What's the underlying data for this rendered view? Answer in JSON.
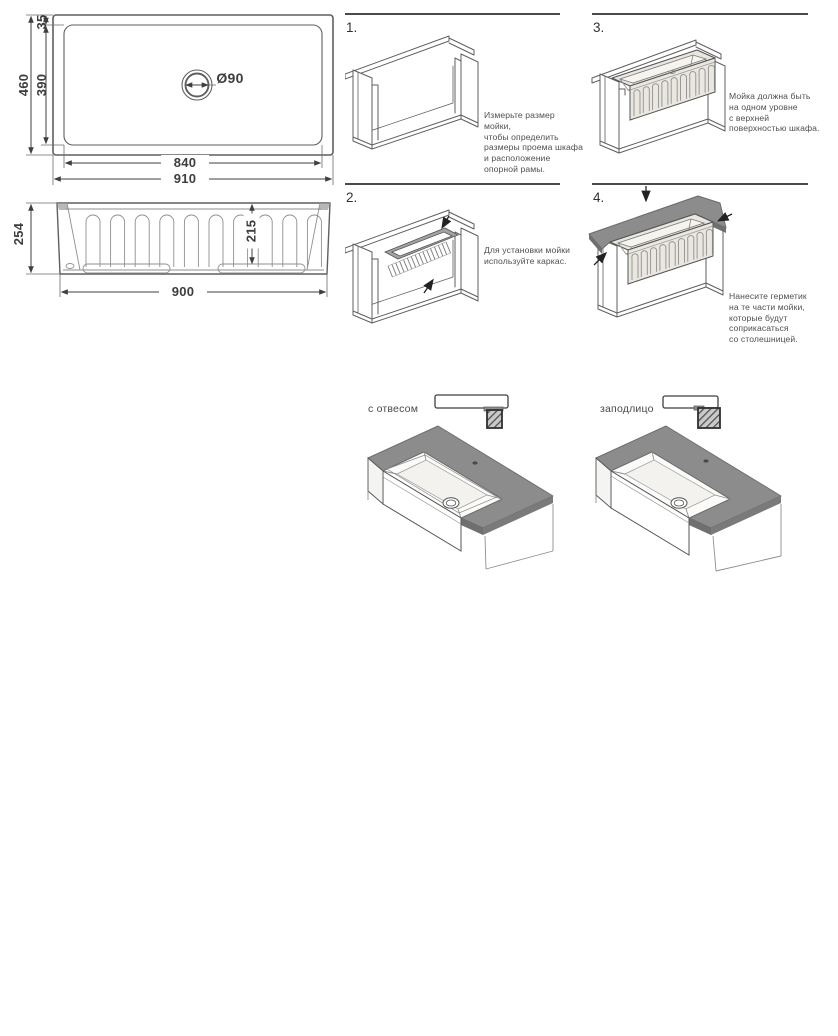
{
  "technical_drawing": {
    "top_view": {
      "overall_width": "910",
      "inner_width": "840",
      "overall_depth": "460",
      "inner_depth": "390",
      "rim_offset": "35",
      "drain_diameter": "Ø90"
    },
    "front_view": {
      "height": "254",
      "bowl_depth": "215",
      "width": "900"
    }
  },
  "steps": [
    {
      "number": "1.",
      "text": "Измерьте размер мойки,\nчтобы определить\nразмеры проема шкафа\nи расположение\nопорной рамы."
    },
    {
      "number": "2.",
      "text": "Для установки мойки\nиспользуйте каркас."
    },
    {
      "number": "3.",
      "text": "Мойка должна быть\nна одном уровне\nс верхней\nповерхностью шкафа."
    },
    {
      "number": "4.",
      "text": "Нанесите герметик\nна те части мойки,\nкоторые будут\nсоприкасаться\nсо столешницей."
    }
  ],
  "mounting_options": [
    {
      "label": "с отвесом"
    },
    {
      "label": "заподлицо"
    }
  ],
  "colors": {
    "line": "#4a4a4a",
    "text": "#4f4f4f",
    "countertop": "#8c8c8c",
    "countertop_edge": "#6f6f6f",
    "sink_fill": "#eae6e0"
  }
}
